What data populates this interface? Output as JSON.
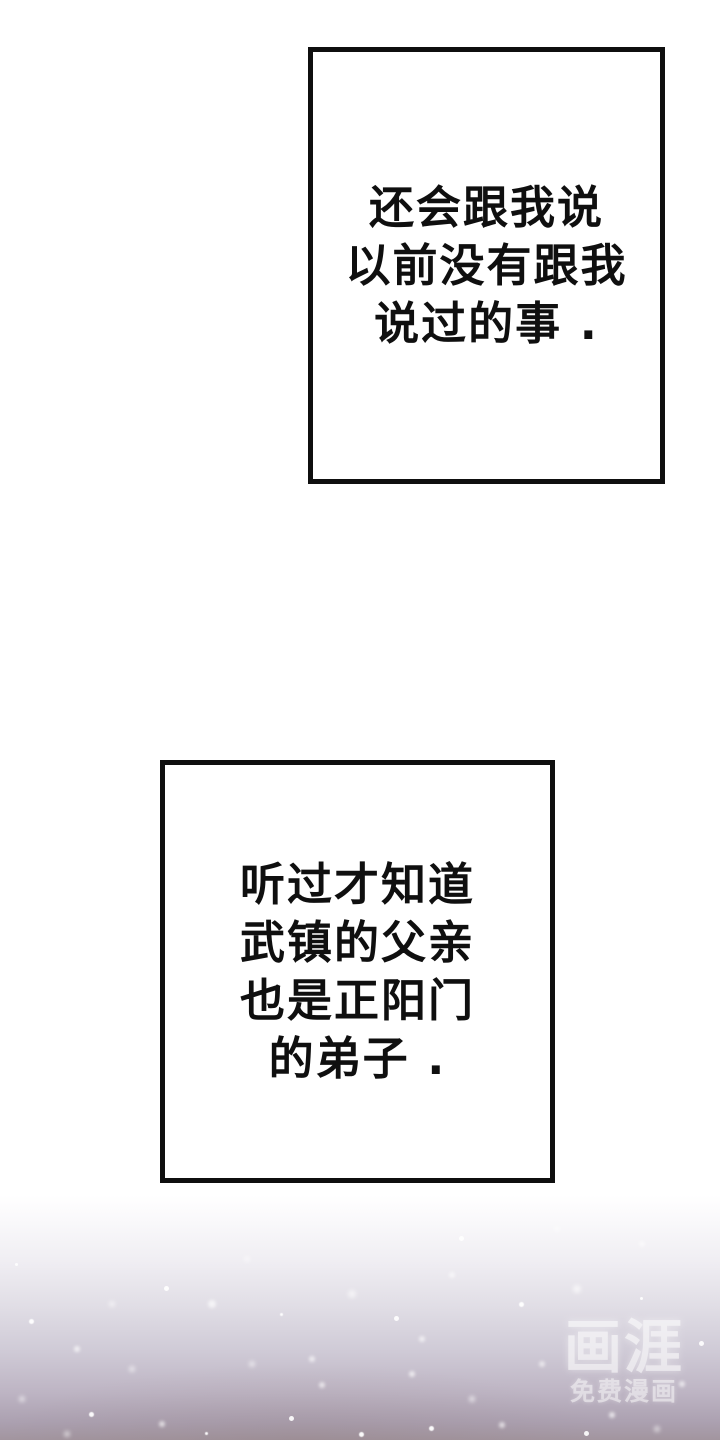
{
  "page": {
    "kind": "comic-page"
  },
  "panels": [
    {
      "lines": [
        "还会跟我说",
        "以前没有跟我",
        "说过的事 ."
      ]
    },
    {
      "lines": [
        "听过才知道",
        "武镇的父亲",
        "也是正阳门",
        "的弟子 ."
      ]
    }
  ],
  "watermark": {
    "logo": "画涯",
    "tagline": "免费漫画"
  },
  "colors": {
    "ink": "#0f0f0f",
    "panel_bg": "#ffffff",
    "gradient_top": "#ffffff",
    "gradient_mid": "#d8d5de",
    "gradient_bottom": "#a2959f",
    "watermark_white": "#ffffff"
  }
}
